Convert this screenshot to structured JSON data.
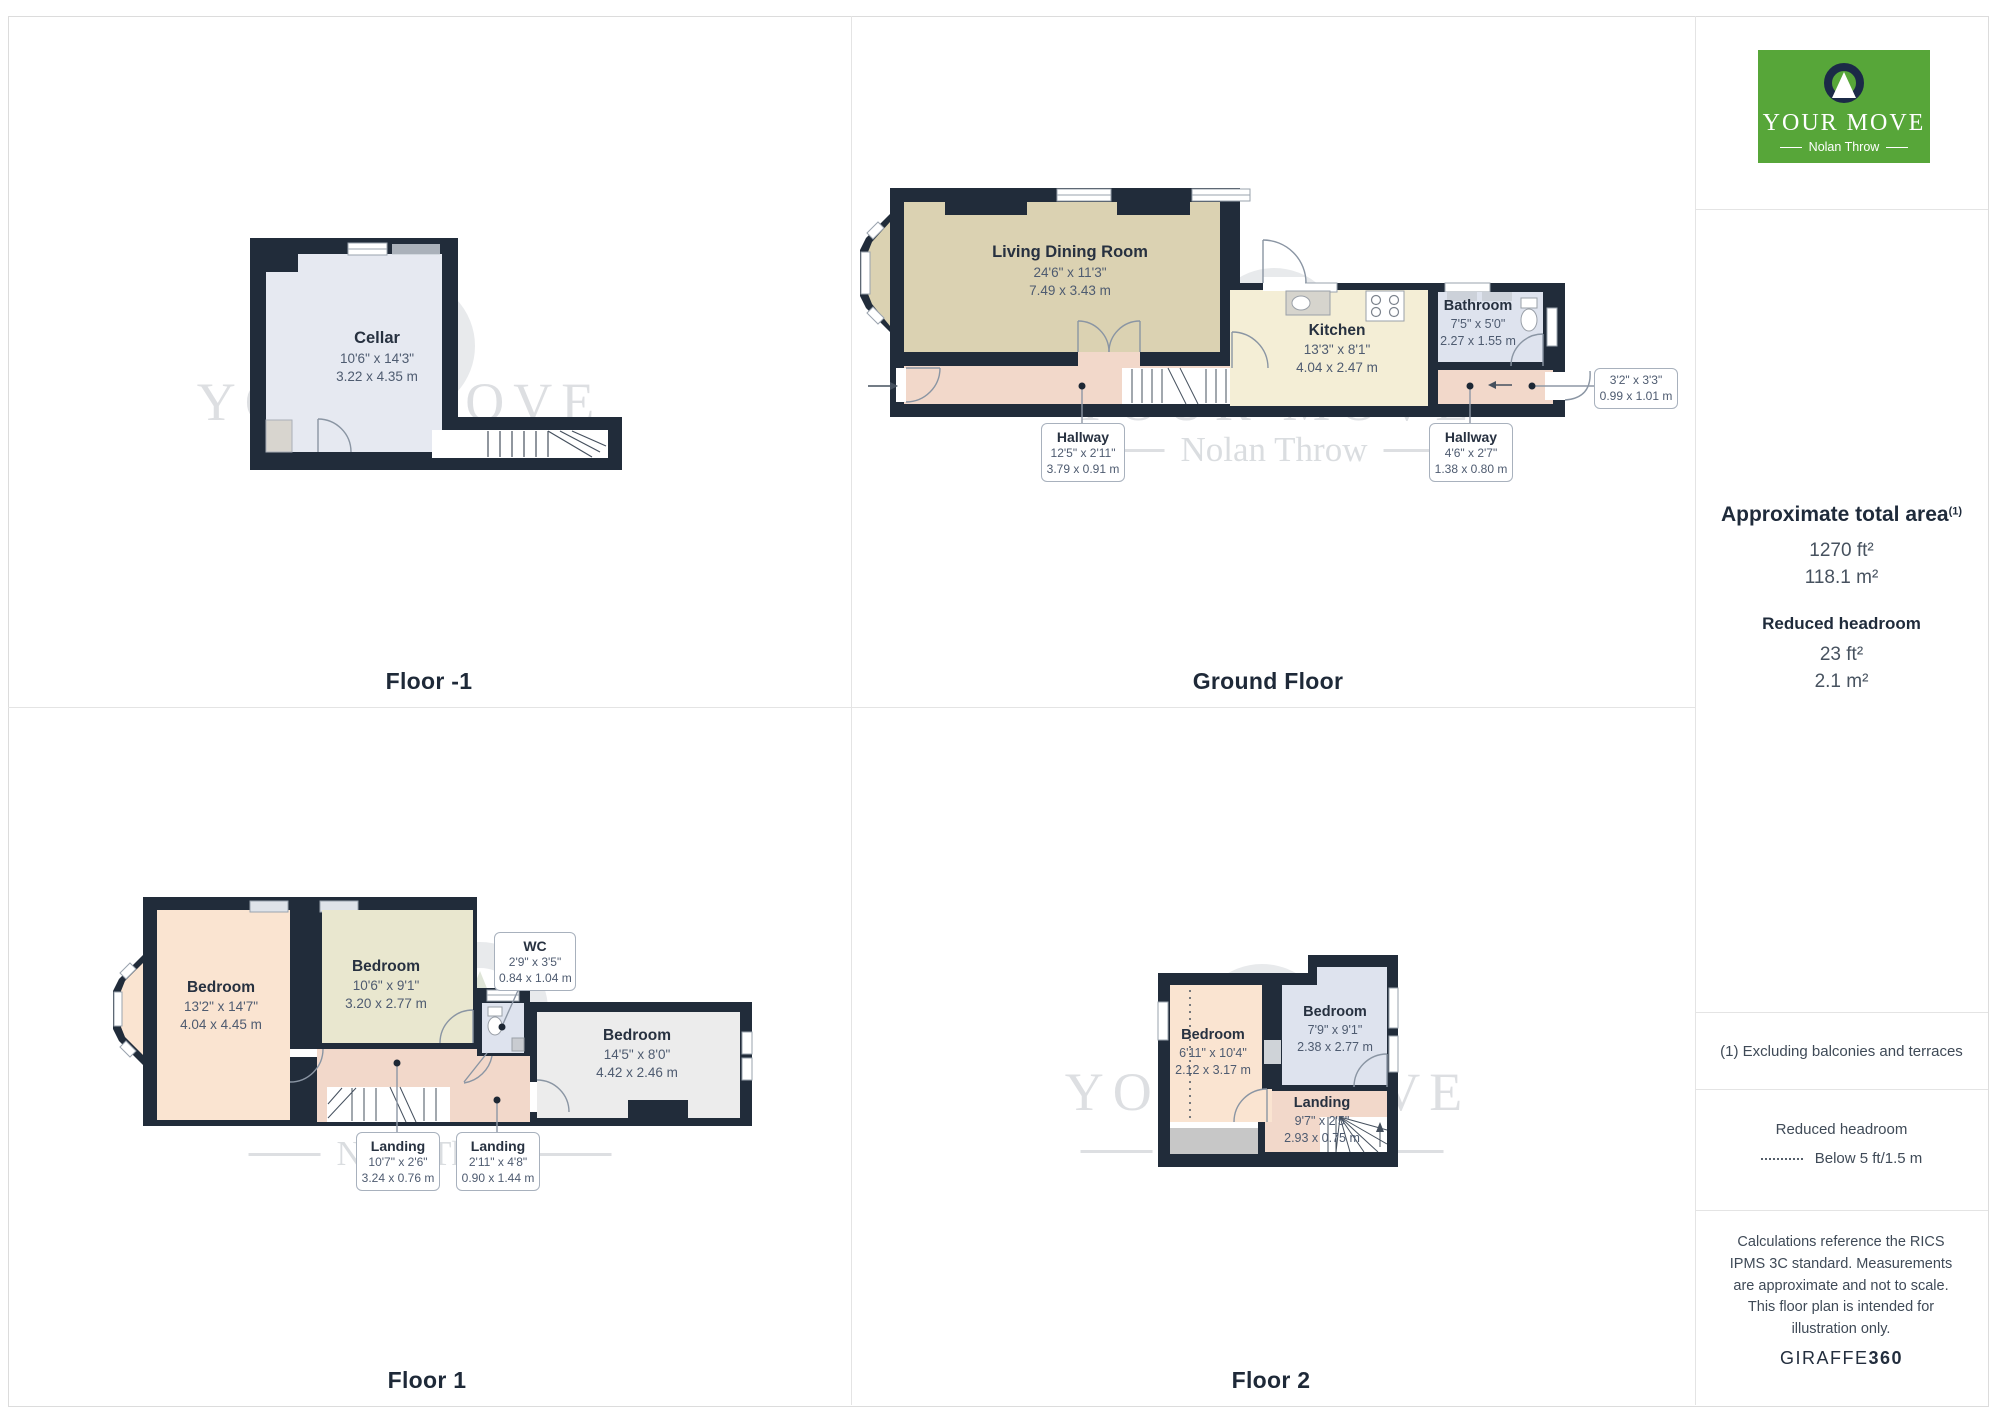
{
  "brand": {
    "logo_line1": "YOUR MOVE",
    "logo_line2": "Nolan Throw",
    "logo_bg": "#57a639",
    "logo_navy": "#1b2a47"
  },
  "watermark": {
    "line1": "YOUR MOVE",
    "line2": "Nolan Throw"
  },
  "plans": {
    "floor_minus1": {
      "label": "Floor -1",
      "rooms": {
        "cellar": {
          "name": "Cellar",
          "imperial": "10'6\" x 14'3\"",
          "metric": "3.22 x 4.35 m"
        }
      }
    },
    "ground": {
      "label": "Ground Floor",
      "rooms": {
        "living": {
          "name": "Living Dining Room",
          "imperial": "24'6\" x 11'3\"",
          "metric": "7.49 x 3.43 m"
        },
        "kitchen": {
          "name": "Kitchen",
          "imperial": "13'3\" x 8'1\"",
          "metric": "4.04 x 2.47 m"
        },
        "bathroom": {
          "name": "Bathroom",
          "imperial": "7'5\" x 5'0\"",
          "metric": "2.27 x 1.55 m"
        },
        "hallway_main": {
          "name": "Hallway",
          "imperial": "12'5\" x 2'11\"",
          "metric": "3.79 x 0.91 m"
        },
        "hallway_rear": {
          "name": "Hallway",
          "imperial": "4'6\" x 2'7\"",
          "metric": "1.38 x 0.80 m"
        },
        "store": {
          "imperial": "3'2\" x 3'3\"",
          "metric": "0.99 x 1.01 m"
        }
      }
    },
    "floor1": {
      "label": "Floor 1",
      "rooms": {
        "bedroom1": {
          "name": "Bedroom",
          "imperial": "13'2\" x 14'7\"",
          "metric": "4.04 x 4.45 m"
        },
        "bedroom2": {
          "name": "Bedroom",
          "imperial": "10'6\" x 9'1\"",
          "metric": "3.20 x 2.77 m"
        },
        "bedroom3": {
          "name": "Bedroom",
          "imperial": "14'5\" x 8'0\"",
          "metric": "4.42 x 2.46 m"
        },
        "wc": {
          "name": "WC",
          "imperial": "2'9\" x 3'5\"",
          "metric": "0.84 x 1.04 m"
        },
        "landing1": {
          "name": "Landing",
          "imperial": "10'7\" x 2'6\"",
          "metric": "3.24 x 0.76 m"
        },
        "landing2": {
          "name": "Landing",
          "imperial": "2'11\" x 4'8\"",
          "metric": "0.90 x 1.44 m"
        }
      }
    },
    "floor2": {
      "label": "Floor 2",
      "rooms": {
        "bedroom1": {
          "name": "Bedroom",
          "imperial": "6'11\" x 10'4\"",
          "metric": "2.12 x 3.17 m"
        },
        "bedroom2": {
          "name": "Bedroom",
          "imperial": "7'9\" x 9'1\"",
          "metric": "2.38 x 2.77 m"
        },
        "landing": {
          "name": "Landing",
          "imperial": "9'7\" x 2'5\"",
          "metric": "2.93 x 0.75 m"
        }
      }
    }
  },
  "sidebar": {
    "area_title": "Approximate total area",
    "area_footnote_mark": "(1)",
    "area_ft": "1270 ft²",
    "area_m": "118.1 m²",
    "headroom_title": "Reduced headroom",
    "headroom_ft": "23 ft²",
    "headroom_m": "2.1 m²",
    "footnote": "(1) Excluding balconies and terraces",
    "legend_title": "Reduced headroom",
    "legend_value": "Below 5 ft/1.5 m",
    "disclaimer": "Calculations reference the RICS IPMS 3C standard. Measurements are approximate and not to scale. This floor plan is intended for illustration only.",
    "brand_footer_name": "GIRAFFE",
    "brand_footer_num": "360"
  }
}
